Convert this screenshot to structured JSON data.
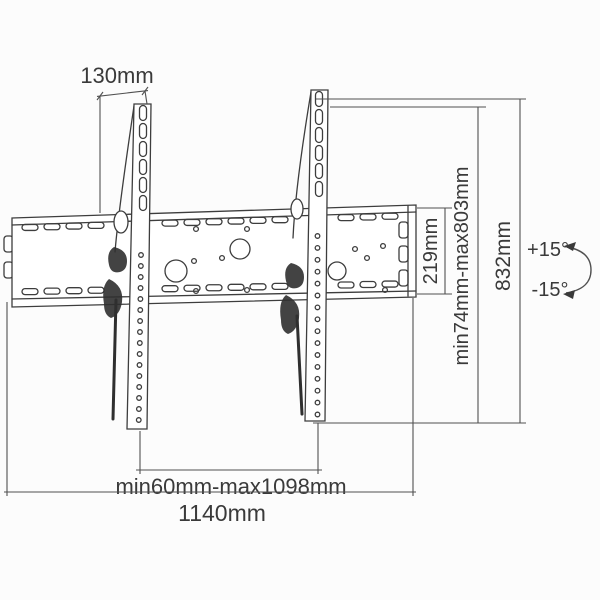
{
  "drawing": {
    "subject": "Tilting TV wall mount bracket dimension diagram",
    "background": "#fcfcfc",
    "line_color": "#3d3d3d",
    "dimension_line_color": "#505050",
    "text_color": "#3a3a3a",
    "labels": {
      "bracket_top_depth": "130mm",
      "wall_plate_height": "219mm",
      "mount_height_range": "min74mm-max803mm",
      "bracket_arm_length": "832mm",
      "tilt_up": "+15°",
      "tilt_down": "-15°",
      "arm_spacing_range": "min60mm-max1098mm",
      "wall_plate_width": "1140mm"
    }
  }
}
